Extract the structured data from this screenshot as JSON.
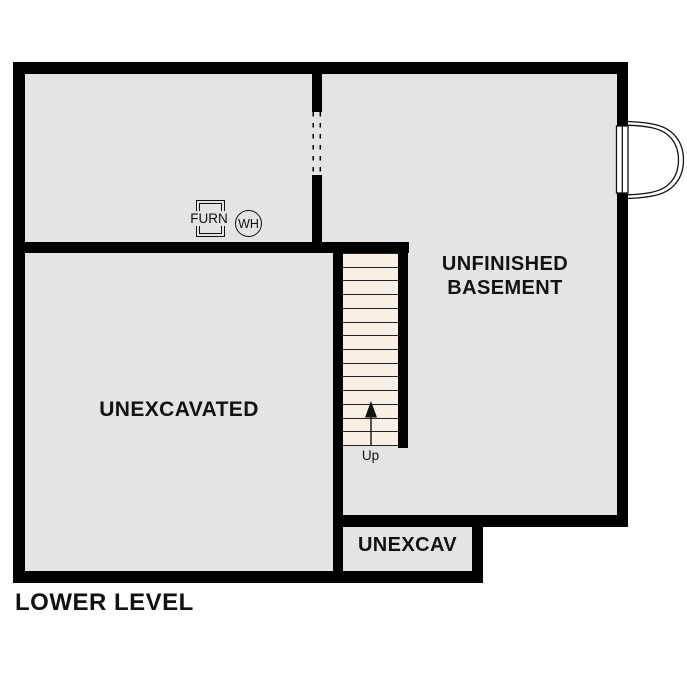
{
  "plan": {
    "title": "LOWER LEVEL"
  },
  "rooms": {
    "basement": {
      "line1": "UNFINISHED",
      "line2": "BASEMENT"
    },
    "unexcavated": {
      "label": "UNEXCAVATED"
    },
    "unexcav": {
      "label": "UNEXCAV"
    }
  },
  "equipment": {
    "furnace": "FURN",
    "water_heater": "WH"
  },
  "stairs": {
    "up_label": "Up",
    "tread_count": 14
  },
  "colors": {
    "wall": "#000000",
    "room_fill": "#e5e4e2",
    "stair_fill": "#f8f0e4",
    "label": "#121212",
    "background": "#ffffff"
  }
}
